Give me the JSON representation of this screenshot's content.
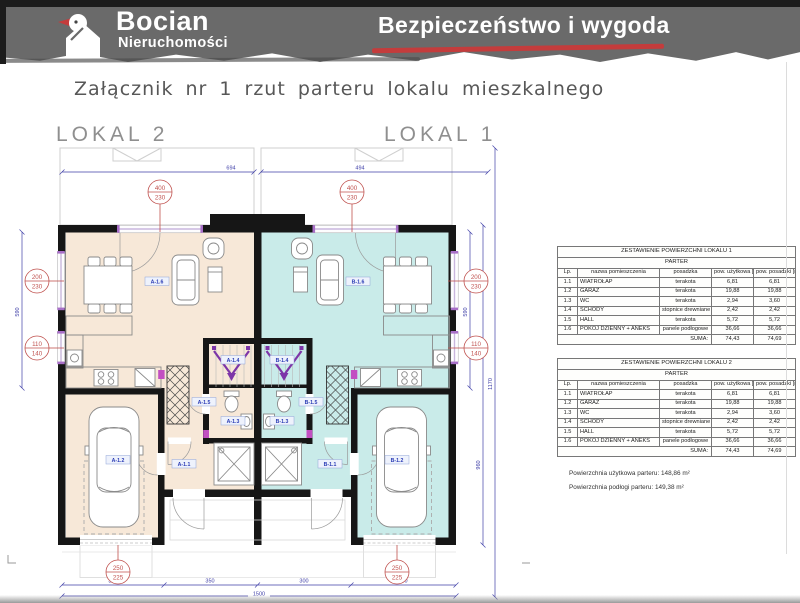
{
  "header": {
    "brand": "Bocian",
    "brand_sub": "Nieruchomości",
    "tagline": "Bezpieczeństwo i wygoda",
    "accent_color": "#c43c3c",
    "bg_color": "#6a6a6a"
  },
  "title": "Załącznik nr 1 rzut parteru lokalu mieszkalnego",
  "plan": {
    "unit_left": "LOKAL 2",
    "unit_right": "LOKAL 1",
    "colors": {
      "unit_left_fill": "#f7e8d8",
      "unit_right_fill": "#c9ebe9"
    },
    "room_labels": {
      "a16": "A-1.6",
      "a15": "A-1.5",
      "a14": "A-1.4",
      "a13": "A-1.3",
      "a12": "A-1.2",
      "a11": "A-1.1",
      "b16": "B-1.6",
      "b15": "B-1.5",
      "b14": "B-1.4",
      "b13": "B-1.3",
      "b12": "B-1.2",
      "b11": "B-1.1"
    },
    "dims": {
      "top_left": "694",
      "top_right": "494",
      "door_top_w": "400",
      "door_top_h": "230",
      "win_large_w": "200",
      "win_large_h": "230",
      "win_small_w": "110",
      "win_small_h": "140",
      "garage_w": "250",
      "garage_h": "225",
      "side": "590",
      "side2": "960",
      "side_total": "1170",
      "seg1": "350",
      "seg2": "350",
      "seg3": "300",
      "seg4": "350",
      "total": "1500"
    }
  },
  "tables": [
    {
      "title": "ZESTAWIENIE POWIERZCHNI LOKALU 1",
      "subtitle": "PARTER",
      "columns": [
        "Lp.",
        "nazwa pomieszczenia",
        "posadzka",
        "pow. użytkowa [m²]",
        "pow. posadzki [m²]"
      ],
      "rows": [
        [
          "1.1",
          "WIATROŁAP",
          "terakota",
          "6,81",
          "6,81"
        ],
        [
          "1.2",
          "GARAŻ",
          "terakota",
          "19,88",
          "19,88"
        ],
        [
          "1.3",
          "WC",
          "terakota",
          "2,94",
          "3,60"
        ],
        [
          "1.4",
          "SCHODY",
          "stopnice drewniane",
          "2,42",
          "2,42"
        ],
        [
          "1.5",
          "HALL",
          "terakota",
          "5,72",
          "5,72"
        ],
        [
          "1.6",
          "POKÓJ DZIENNY + ANEKS",
          "panele podłogowe",
          "36,66",
          "36,66"
        ]
      ],
      "sum_label": "SUMA:",
      "sum_values": [
        "74,43",
        "74,69"
      ]
    },
    {
      "title": "ZESTAWIENIE POWIERZCHNI LOKALU 2",
      "subtitle": "PARTER",
      "columns": [
        "Lp.",
        "nazwa pomieszczenia",
        "posadzka",
        "pow. użytkowa [m²]",
        "pow. posadzki [m²]"
      ],
      "rows": [
        [
          "1.1",
          "WIATROŁAP",
          "terakota",
          "6,81",
          "6,81"
        ],
        [
          "1.2",
          "GARAŻ",
          "terakota",
          "19,88",
          "19,88"
        ],
        [
          "1.3",
          "WC",
          "terakota",
          "2,94",
          "3,60"
        ],
        [
          "1.4",
          "SCHODY",
          "stopnice drewniane",
          "2,42",
          "2,42"
        ],
        [
          "1.5",
          "HALL",
          "terakota",
          "5,72",
          "5,72"
        ],
        [
          "1.6",
          "POKÓJ DZIENNY + ANEKS",
          "panele podłogowe",
          "36,66",
          "36,66"
        ]
      ],
      "sum_label": "SUMA:",
      "sum_values": [
        "74,43",
        "74,69"
      ]
    }
  ],
  "summary": {
    "line1": "Powierzchnia użytkowa parteru: 148,86 m²",
    "line2": "Powierzchnia podłogi parteru: 149,38 m²"
  }
}
